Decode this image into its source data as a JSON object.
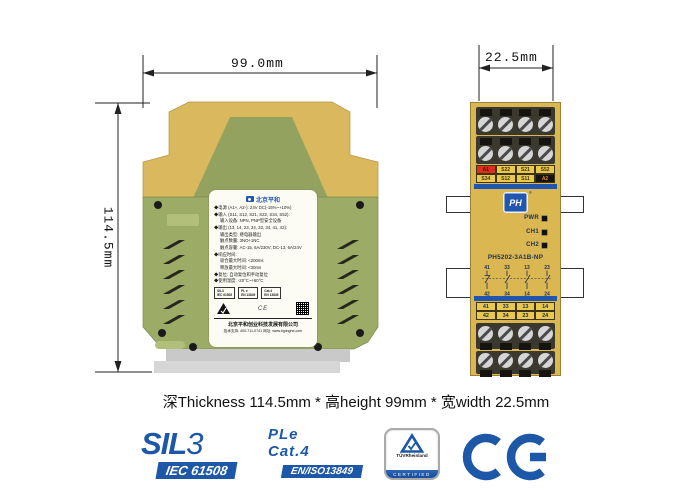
{
  "caption": "深Thickness 114.5mm * 高height 99mm * 宽width 22.5mm",
  "side_view": {
    "dim_width": "99.0mm",
    "dim_height": "114.5mm",
    "label": {
      "brand": "北京平和",
      "spec_lines": [
        "◆电源 (A1+, A2-): 24V DC(-15%~+10%)",
        "◆输入 (S11, S12, S21, S22, S34, S52):",
        "输入设备: NPN, PNP型安全设备",
        "◆输出 (13, 14, 23, 24, 33, 34, 41, 42):",
        "输出类型: 继电器输出",
        "触点数量: 3NO+1NC",
        "触点容量: AC-15, 6A/230V; DC-13, 6A/24V",
        "◆响应时间:",
        "吸合最大时间: <200ms",
        "释放最大时间: <30ms",
        "◆复位: 自动复位和手动复位",
        "◆使用温度: -20°C~+60°C"
      ],
      "cert_boxes": [
        {
          "line1": "SIL3",
          "line2": "IEC 61508"
        },
        {
          "line1": "PL e",
          "line2": "EN 13849"
        },
        {
          "line1": "Cat.4",
          "line2": "EN 13849"
        }
      ],
      "company": "北京平和创业科技发展有限公司",
      "contact": "技术支持: 400-711-0741  网址: www.bjpinghe.com"
    }
  },
  "front_view": {
    "dim_width": "22.5mm",
    "brand_logo": "PH",
    "top_terminals": {
      "row1": [
        "A1",
        "S22",
        "S21",
        "S52"
      ],
      "row2": [
        "S34",
        "S12",
        "S11",
        "A2"
      ]
    },
    "leds": [
      "PWR",
      "CH1",
      "CH2"
    ],
    "model": "PH5202-3A1B-NP",
    "contact_diagram": {
      "top": [
        "41",
        "33",
        "13",
        "23"
      ],
      "bottom": [
        "42",
        "34",
        "14",
        "24"
      ]
    },
    "bottom_terminals": {
      "row1": [
        "41",
        "33",
        "13",
        "14"
      ],
      "row2": [
        "42",
        "34",
        "23",
        "24"
      ]
    }
  },
  "certifications": {
    "sil": {
      "title": "SIL",
      "level": "3",
      "badge": "IEC 61508"
    },
    "ple": {
      "line1": "PLe",
      "line2": "Cat.4",
      "badge": "EN/ISO13849"
    },
    "tuv": {
      "name": "TÜVRheinland",
      "sub": "CERTIFIED"
    },
    "ce": {
      "label": "CE"
    }
  },
  "colors": {
    "accent_blue": "#1d57a8",
    "module_yellow": "#d9b85e",
    "module_green": "#9cab66",
    "front_blue_strip": "#2055b0",
    "terminal_red": "#dd2f1e",
    "rail_gray": "#c9c9c9"
  }
}
